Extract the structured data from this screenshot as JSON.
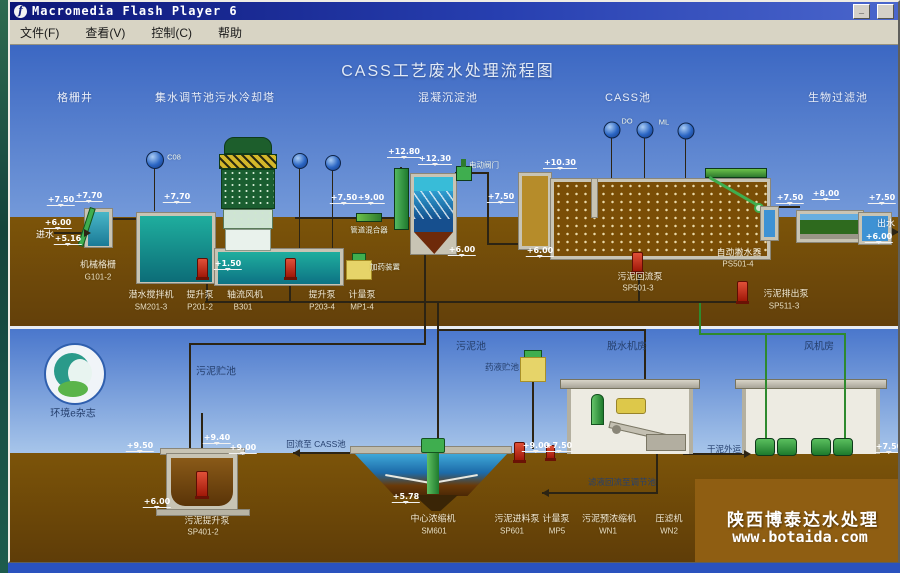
{
  "window": {
    "title": "Macromedia Flash Player 6",
    "minimize_label": "_",
    "maximize_label": ""
  },
  "menu_bar": {
    "items": [
      {
        "id": "file",
        "label": "文件(F)"
      },
      {
        "id": "view",
        "label": "查看(V)"
      },
      {
        "id": "control",
        "label": "控制(C)"
      },
      {
        "id": "help",
        "label": "帮助"
      }
    ]
  },
  "diagram": {
    "title": "CASS工艺废水处理流程图",
    "watermark": {
      "line1": "陕西博泰达水处理",
      "line2": "www.botaida.com"
    },
    "labels": [
      {
        "t": "格栅井",
        "x": 75,
        "y": 96,
        "c": "sec"
      },
      {
        "t": "集水调节池",
        "x": 185,
        "y": 96,
        "c": "sec"
      },
      {
        "t": "污水冷却塔",
        "x": 245,
        "y": 96,
        "c": "sec"
      },
      {
        "t": "混凝沉淀池",
        "x": 448,
        "y": 96,
        "c": "sec"
      },
      {
        "t": "CASS池",
        "x": 628,
        "y": 96,
        "c": "sec"
      },
      {
        "t": "生物过滤池",
        "x": 838,
        "y": 96,
        "c": "sec"
      },
      {
        "t": "进水",
        "x": 45,
        "y": 233,
        "c": "w9"
      },
      {
        "t": "出水",
        "x": 886,
        "y": 222,
        "c": "w9"
      },
      {
        "t": "C08",
        "x": 174,
        "y": 156,
        "c": "t7"
      },
      {
        "t": "DO",
        "x": 627,
        "y": 120,
        "c": "t7"
      },
      {
        "t": "ML",
        "x": 664,
        "y": 121,
        "c": "t7"
      },
      {
        "t": "电动阀门",
        "x": 484,
        "y": 164,
        "c": "t7"
      },
      {
        "t": "加药装置",
        "x": 385,
        "y": 266,
        "c": "t7"
      },
      {
        "t": "管道混合器",
        "x": 369,
        "y": 229,
        "c": "t7"
      },
      {
        "t": "机械格栅",
        "x": 98,
        "y": 263,
        "c": "eq"
      },
      {
        "t": "G101-2",
        "x": 98,
        "y": 276,
        "c": "tag"
      },
      {
        "t": "潜水搅拌机",
        "x": 151,
        "y": 293,
        "c": "eq"
      },
      {
        "t": "SM201-3",
        "x": 151,
        "y": 306,
        "c": "tag"
      },
      {
        "t": "提升泵",
        "x": 200,
        "y": 293,
        "c": "eq"
      },
      {
        "t": "P201-2",
        "x": 200,
        "y": 306,
        "c": "tag"
      },
      {
        "t": "轴流风机",
        "x": 245,
        "y": 293,
        "c": "eq"
      },
      {
        "t": "B301",
        "x": 243,
        "y": 306,
        "c": "tag"
      },
      {
        "t": "提升泵",
        "x": 322,
        "y": 293,
        "c": "eq"
      },
      {
        "t": "P203-4",
        "x": 322,
        "y": 306,
        "c": "tag"
      },
      {
        "t": "计量泵",
        "x": 362,
        "y": 293,
        "c": "eq"
      },
      {
        "t": "MP1-4",
        "x": 362,
        "y": 306,
        "c": "tag"
      },
      {
        "t": "自动撇水器",
        "x": 739,
        "y": 251,
        "c": "eq"
      },
      {
        "t": "PS501-4",
        "x": 738,
        "y": 263,
        "c": "tag"
      },
      {
        "t": "污泥回流泵",
        "x": 640,
        "y": 275,
        "c": "eq"
      },
      {
        "t": "SP501-3",
        "x": 638,
        "y": 287,
        "c": "tag"
      },
      {
        "t": "污泥排出泵",
        "x": 786,
        "y": 292,
        "c": "eq"
      },
      {
        "t": "SP511-3",
        "x": 784,
        "y": 305,
        "c": "tag"
      },
      {
        "t": "污泥贮池",
        "x": 216,
        "y": 369,
        "c": "dk"
      },
      {
        "t": "污泥池",
        "x": 471,
        "y": 344,
        "c": "dk"
      },
      {
        "t": "药液贮池",
        "x": 502,
        "y": 366,
        "c": "dk8"
      },
      {
        "t": "脱水机房",
        "x": 627,
        "y": 344,
        "c": "dk"
      },
      {
        "t": "风机房",
        "x": 819,
        "y": 344,
        "c": "dk"
      },
      {
        "t": "环境e杂志",
        "x": 73,
        "y": 411,
        "c": "dk"
      },
      {
        "t": "回流至 CASS池",
        "x": 316,
        "y": 443,
        "c": "dk8"
      },
      {
        "t": "干泥外运",
        "x": 724,
        "y": 448,
        "c": "dk8"
      },
      {
        "t": "滤液回流至调节池",
        "x": 622,
        "y": 481,
        "c": "dk8"
      },
      {
        "t": "污泥提升泵",
        "x": 207,
        "y": 519,
        "c": "eq"
      },
      {
        "t": "SP401-2",
        "x": 203,
        "y": 531,
        "c": "tag"
      },
      {
        "t": "中心浓缩机",
        "x": 433,
        "y": 517,
        "c": "eq"
      },
      {
        "t": "SM601",
        "x": 434,
        "y": 530,
        "c": "tag"
      },
      {
        "t": "污泥进料泵",
        "x": 517,
        "y": 517,
        "c": "eq"
      },
      {
        "t": "SP601",
        "x": 512,
        "y": 530,
        "c": "tag"
      },
      {
        "t": "计量泵",
        "x": 556,
        "y": 517,
        "c": "eq"
      },
      {
        "t": "MP5",
        "x": 557,
        "y": 530,
        "c": "tag"
      },
      {
        "t": "污泥预浓缩机",
        "x": 609,
        "y": 517,
        "c": "eq"
      },
      {
        "t": "WN1",
        "x": 608,
        "y": 530,
        "c": "tag"
      },
      {
        "t": "压滤机",
        "x": 669,
        "y": 517,
        "c": "eq"
      },
      {
        "t": "WN2",
        "x": 669,
        "y": 530,
        "c": "tag"
      },
      {
        "t": "陕西博泰达水处理",
        "x": 803,
        "y": 517,
        "c": "wm1"
      },
      {
        "t": "www.botaida.com",
        "x": 800,
        "y": 536,
        "c": "wm2"
      }
    ],
    "elevations": [
      {
        "v": "+7.50",
        "x": 61,
        "y": 205
      },
      {
        "v": "+7.70",
        "x": 89,
        "y": 201
      },
      {
        "v": "+6.00",
        "x": 58,
        "y": 228
      },
      {
        "v": "+5.16",
        "x": 68,
        "y": 244
      },
      {
        "v": "+7.70",
        "x": 177,
        "y": 202
      },
      {
        "v": "+1.50",
        "x": 228,
        "y": 269
      },
      {
        "v": "+7.50",
        "x": 344,
        "y": 203
      },
      {
        "v": "+9.00",
        "x": 371,
        "y": 203
      },
      {
        "v": "+12.80",
        "x": 404,
        "y": 157
      },
      {
        "v": "+12.30",
        "x": 435,
        "y": 164
      },
      {
        "v": "+7.50",
        "x": 501,
        "y": 202
      },
      {
        "v": "+6.00",
        "x": 462,
        "y": 255
      },
      {
        "v": "+6.00",
        "x": 540,
        "y": 256
      },
      {
        "v": "+10.30",
        "x": 560,
        "y": 168
      },
      {
        "v": "+7.50",
        "x": 790,
        "y": 203
      },
      {
        "v": "+8.00",
        "x": 826,
        "y": 199
      },
      {
        "v": "+7.50",
        "x": 882,
        "y": 203
      },
      {
        "v": "+6.00",
        "x": 879,
        "y": 242
      },
      {
        "v": "+9.50",
        "x": 140,
        "y": 451
      },
      {
        "v": "+9.40",
        "x": 217,
        "y": 443
      },
      {
        "v": "+9.00",
        "x": 243,
        "y": 453
      },
      {
        "v": "+6.00",
        "x": 157,
        "y": 507
      },
      {
        "v": "+5.78",
        "x": 406,
        "y": 502
      },
      {
        "v": "+9.00",
        "x": 536,
        "y": 451
      },
      {
        "v": "+7.50",
        "x": 559,
        "y": 451
      },
      {
        "v": "+7.50",
        "x": 889,
        "y": 452
      }
    ]
  }
}
